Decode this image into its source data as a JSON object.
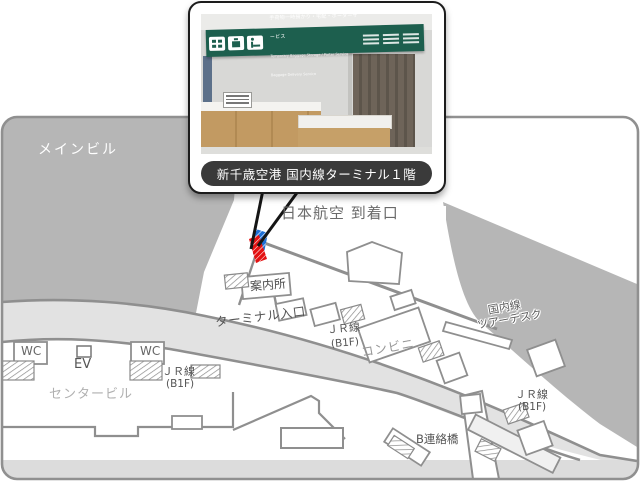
{
  "photo_card": {
    "caption": "新千歳空港 国内線ターミナル１階",
    "sign": {
      "line1": "手荷物一時預かり・宅配・ポーターサービス",
      "line2": "Temporary Baggage Storage / Porter Service",
      "line3": "Baggage Delivery Service"
    }
  },
  "map": {
    "labels": {
      "main_building": "メインビル",
      "jal_arrival_gate": "日本航空 到着口",
      "information_desk": "案内所",
      "terminal_entrance": "ターミナル入口",
      "jr_line": "ＪＲ線",
      "jr_line_floor": "(B1F)",
      "convenience_store": "コンビニ",
      "tour_desk_line1": "国内線",
      "tour_desk_line2": "ツアーデスク",
      "b_bridge": "B連絡橋",
      "wc": "WC",
      "elevator": "EV",
      "center_building": "センタービル"
    },
    "colors": {
      "building_gray": "#b6b6b6",
      "road_gray": "#e2e2e2",
      "strip_gray": "#dcdcdc",
      "outline_gray": "#8f8f8f",
      "marker_red": "#e31111",
      "marker_blue": "#1e6fd6",
      "sign_green": "#1d5f4e",
      "caption_bg": "#3a3a3a"
    }
  }
}
